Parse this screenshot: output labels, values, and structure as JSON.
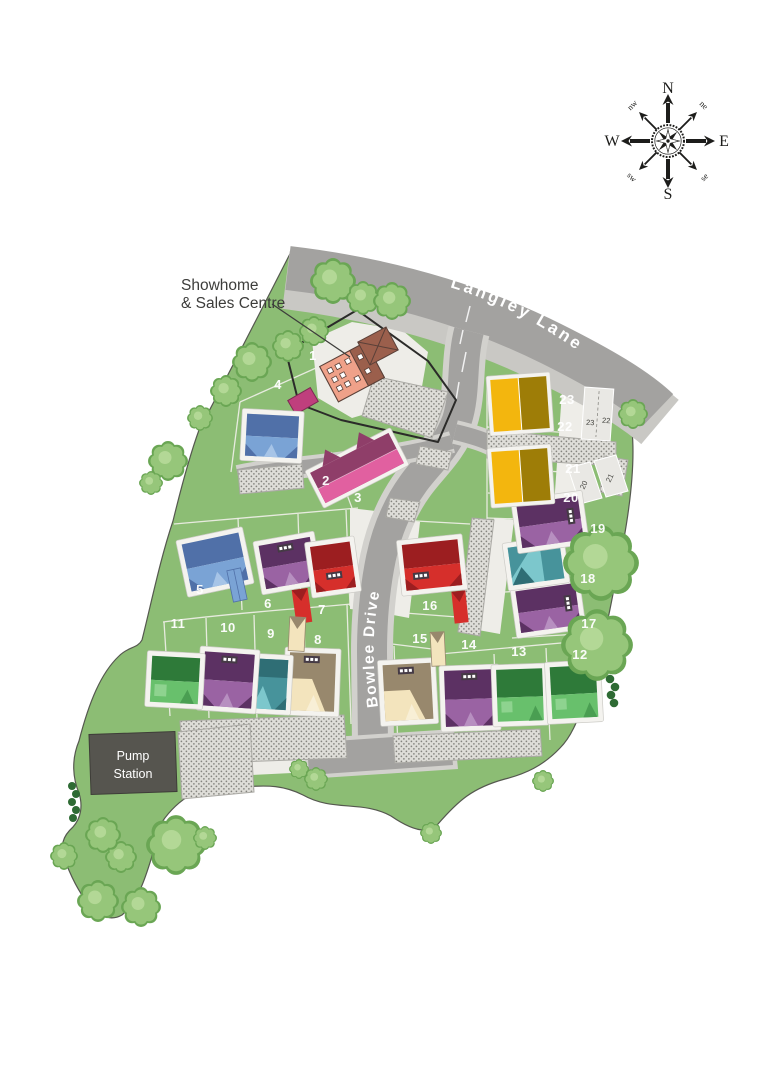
{
  "plan": {
    "labels": {
      "showhome_line1": "Showhome",
      "showhome_line2": "& Sales Centre",
      "pump_line1": "Pump",
      "pump_line2": "Station"
    },
    "roads": {
      "langley": "Langley Lane",
      "bowlee": "Bowlee Drive"
    },
    "compass": {
      "n": "N",
      "e": "E",
      "s": "S",
      "w": "W",
      "nw": "nw",
      "ne": "ne",
      "sw": "sw",
      "se": "se"
    },
    "plots": [
      {
        "number": "1",
        "house_color": "salmon"
      },
      {
        "number": "2",
        "house_color": "pink"
      },
      {
        "number": "3",
        "house_color": "pink"
      },
      {
        "number": "4",
        "house_color": "blue"
      },
      {
        "number": "5",
        "house_color": "blue"
      },
      {
        "number": "6",
        "house_color": "purple"
      },
      {
        "number": "7",
        "house_color": "red"
      },
      {
        "number": "8",
        "house_color": "cream"
      },
      {
        "number": "9",
        "house_color": "teal"
      },
      {
        "number": "10",
        "house_color": "purple"
      },
      {
        "number": "11",
        "house_color": "green_house"
      },
      {
        "number": "12",
        "house_color": "green_house"
      },
      {
        "number": "13",
        "house_color": "green_house"
      },
      {
        "number": "14",
        "house_color": "purple"
      },
      {
        "number": "15",
        "house_color": "cream"
      },
      {
        "number": "16",
        "house_color": "red"
      },
      {
        "number": "17",
        "house_color": "purple"
      },
      {
        "number": "18",
        "house_color": "teal"
      },
      {
        "number": "19",
        "house_color": "purple"
      },
      {
        "number": "20",
        "house_color": "yellow"
      },
      {
        "number": "21",
        "house_color": "gold"
      },
      {
        "number": "22",
        "house_color": "yellow"
      },
      {
        "number": "23",
        "house_color": "gold"
      }
    ],
    "parking": [
      "23",
      "22",
      "20",
      "21"
    ],
    "palette": {
      "site_green": "#8cbd74",
      "road_grey": "#a3a2a0",
      "road_edge": "#c9c8c4",
      "hatch_dot": "#85847f",
      "pump_grey": "#56554f",
      "tree_green": "#96c67a",
      "hedge_green": "#2e6b34",
      "salmon": "#efa189",
      "salmon_dark": "#9b5f4c",
      "pink": "#e160a0",
      "pink_dark": "#8f3e69",
      "blue": "#7aa3d5",
      "blue_dark": "#5070a8",
      "purple": "#9a63a3",
      "purple_dark": "#5c3163",
      "red": "#d62f2b",
      "red_dark": "#9c1e20",
      "cream": "#f3e4bd",
      "cream_dark": "#98886d",
      "teal": "#47939b",
      "teal_light": "#7cc7cc",
      "green_house": "#2e7a39",
      "green_house_light": "#68c06c",
      "yellow": "#f3b60e",
      "gold": "#9e7d07",
      "magenta_store": "#bf3f7d",
      "label_white": "#ffffff",
      "text_dark": "#3d3d3b"
    }
  }
}
